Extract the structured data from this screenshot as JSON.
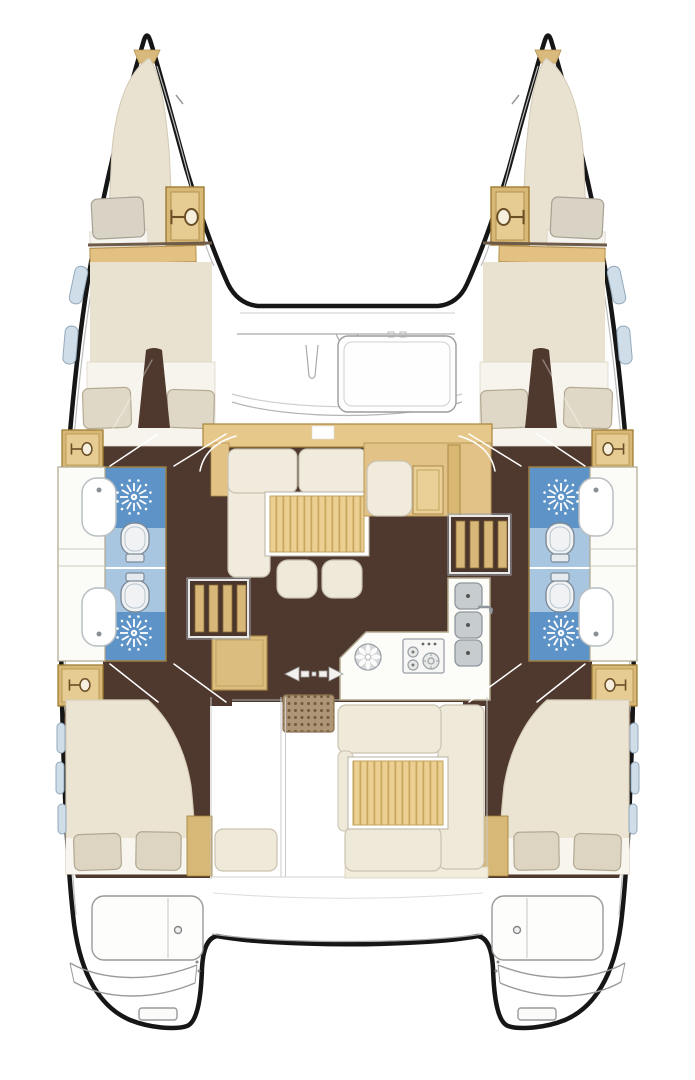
{
  "diagram": {
    "type": "boat-floor-plan",
    "subject": "Catamaran interior layout, top-down view, two symmetric hulls joined by bridgedeck",
    "counts": {
      "hulls": 2,
      "double_cabins": 4,
      "bow_berths": 2,
      "bathrooms": 4,
      "toilets": 4,
      "shower_drains": 4,
      "bathroom_sinks": 4,
      "vanity_cabinets": 6,
      "galley_sinks": 3,
      "stove_burners": 3,
      "salon_ottomans": 2,
      "tables": 2,
      "transom_platforms": 2
    },
    "areas": {
      "port_hull": [
        "bow-berth",
        "forward-cabin",
        "bathroom-fwd",
        "bathroom-aft",
        "aft-double-cabin"
      ],
      "starboard_hull": [
        "bow-berth",
        "forward-cabin",
        "bathroom-fwd",
        "bathroom-aft",
        "aft-double-cabin"
      ],
      "bridgedeck": [
        "foredeck-hatch",
        "salon-l-sofa",
        "salon-table",
        "nav-station",
        "companionway-steps-port",
        "companionway-steps-starboard",
        "galley",
        "sliding-door",
        "doormat",
        "cockpit-u-sofa",
        "cockpit-table",
        "transoms"
      ]
    },
    "icons": [
      "vanity-sink-icon",
      "shower-drain-sunburst-icon",
      "toilet-icon",
      "stove-burners-icon",
      "vent-fan-icon",
      "sliding-door-arrows-icon",
      "doormat-dots-icon",
      "hull-window-icon",
      "engine-hatch-circle-icon"
    ]
  },
  "palette": {
    "hull_outline": "#161616",
    "liner_gray": "#b9b9b9",
    "floor_dark_brown": "#4f382d",
    "wood_tan": "#e3c285",
    "cabinet_tan": "#d8b877",
    "strip_gold": "#e7c88b",
    "upholstery_cream": "#efe9da",
    "bed_cream": "#ebe4d2",
    "bedding_white": "#f6f4ec",
    "pillow_beige": "#ddd5c2",
    "shower_blue": "#5e93c8",
    "toilet_cell_blue": "#a9c6e1",
    "fixture_white": "#fcfcf9",
    "fixture_gray": "#c7cccf",
    "window_blue": "#cfdde9",
    "mat_brown": "#ad9575",
    "table_wood": "#ecd093"
  }
}
